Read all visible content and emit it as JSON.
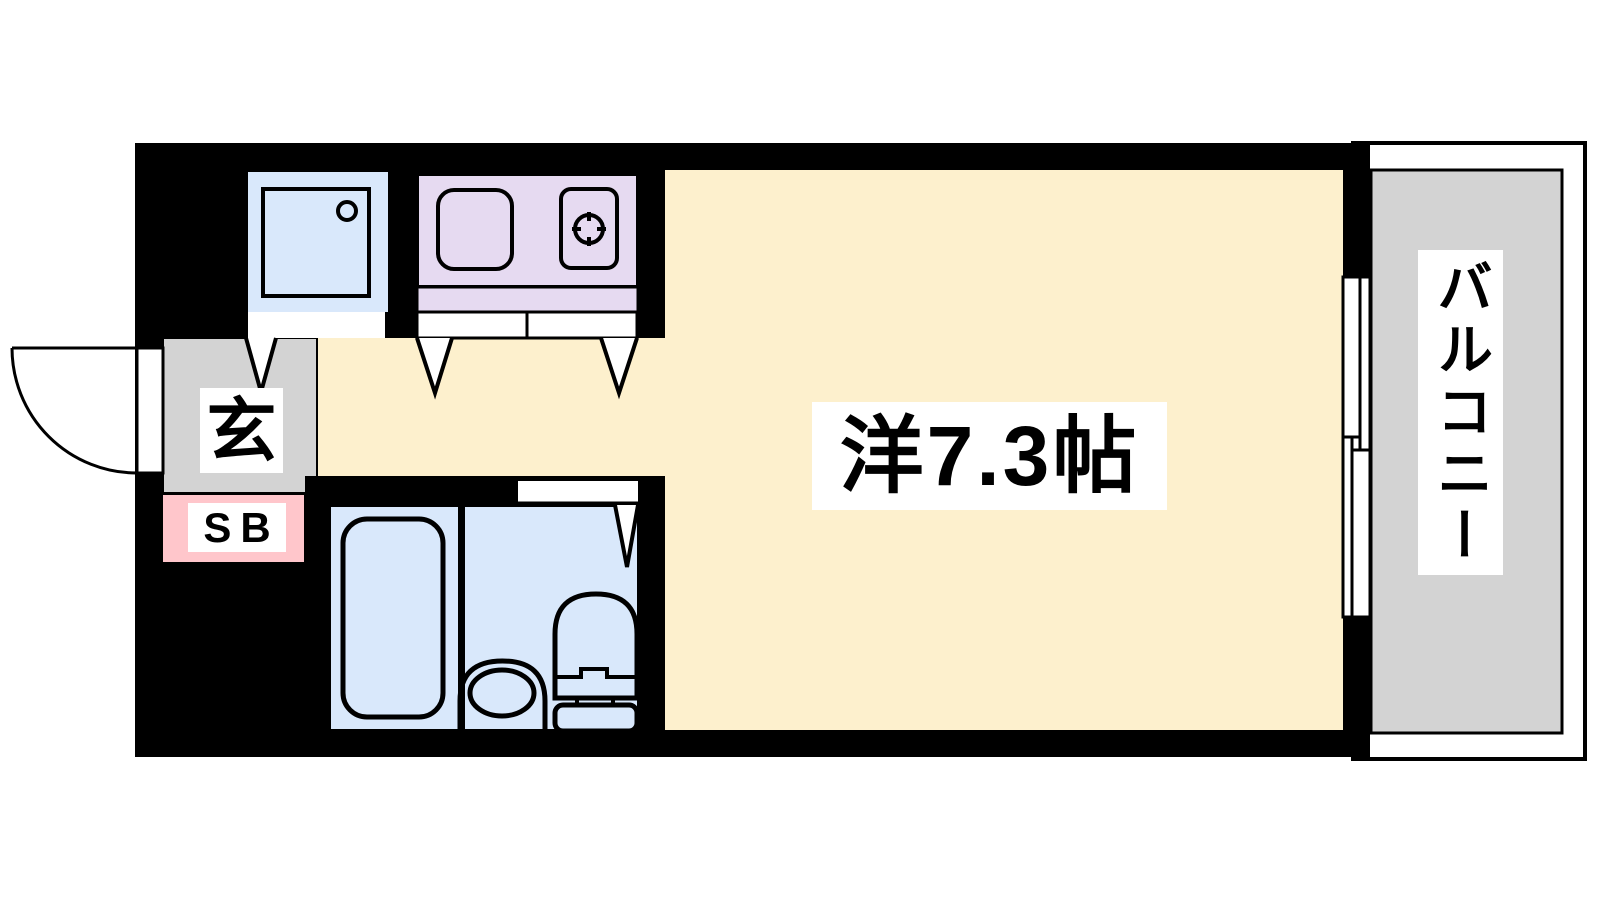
{
  "floorplan": {
    "labels": {
      "main_room": "洋7.3帖",
      "entrance": "玄",
      "shoe_box": "SB",
      "balcony": "バルコニー"
    },
    "colors": {
      "wall": "#000000",
      "main_room_fill": "#fdf0cd",
      "wet_area_fill": "#d9e8fb",
      "kitchen_fill": "#e6daf1",
      "entrance_fill": "#d3d3d3",
      "balcony_fill": "#d3d3d3",
      "shoe_box_fill": "#ffc6cb",
      "opening_fill": "#ffffff"
    },
    "fixtures": [
      "washer-pan-icon",
      "kitchen-sink-icon",
      "gas-stove-icon",
      "bathtub-icon",
      "toilet-icon",
      "entry-door-swing-icon",
      "sliding-window-icon",
      "door-opening-arrow-icon"
    ]
  }
}
